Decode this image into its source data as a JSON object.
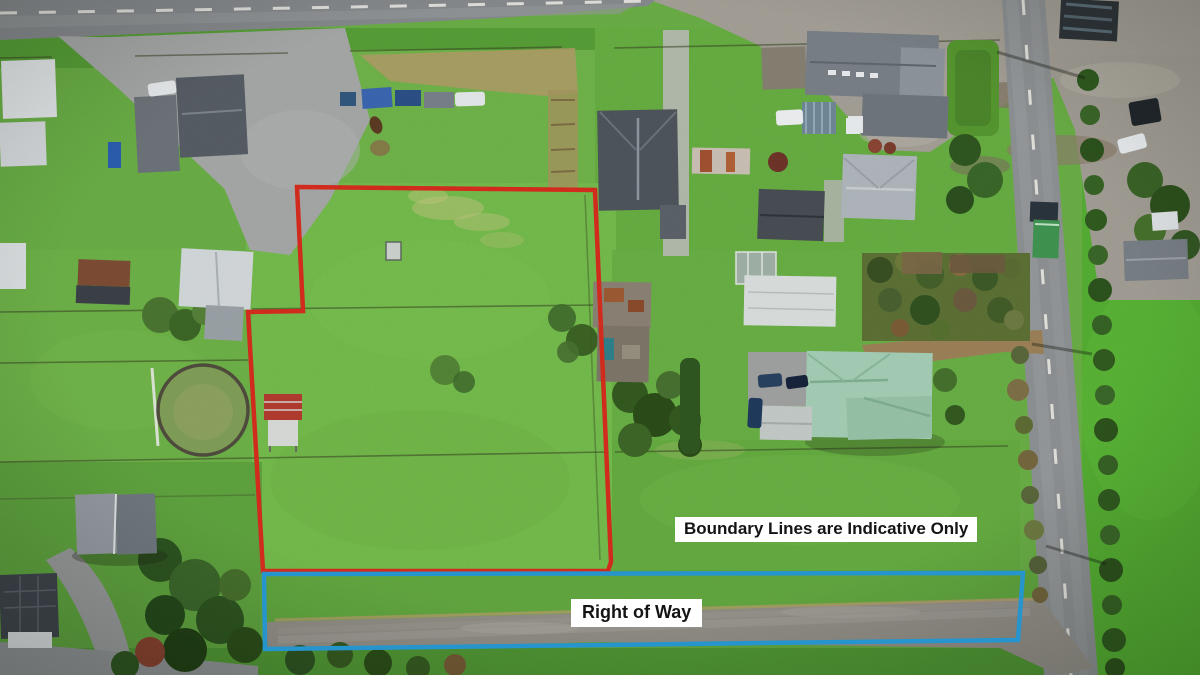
{
  "annotations": {
    "boundary_note": {
      "text": "Boundary Lines are Indicative Only"
    },
    "right_of_way": {
      "text": "Right of Way"
    }
  },
  "colors": {
    "boundary_line_red": "#d02b1d",
    "right_of_way_blue": "#2795cd",
    "label_background": "#ffffff",
    "label_text": "#141414"
  }
}
